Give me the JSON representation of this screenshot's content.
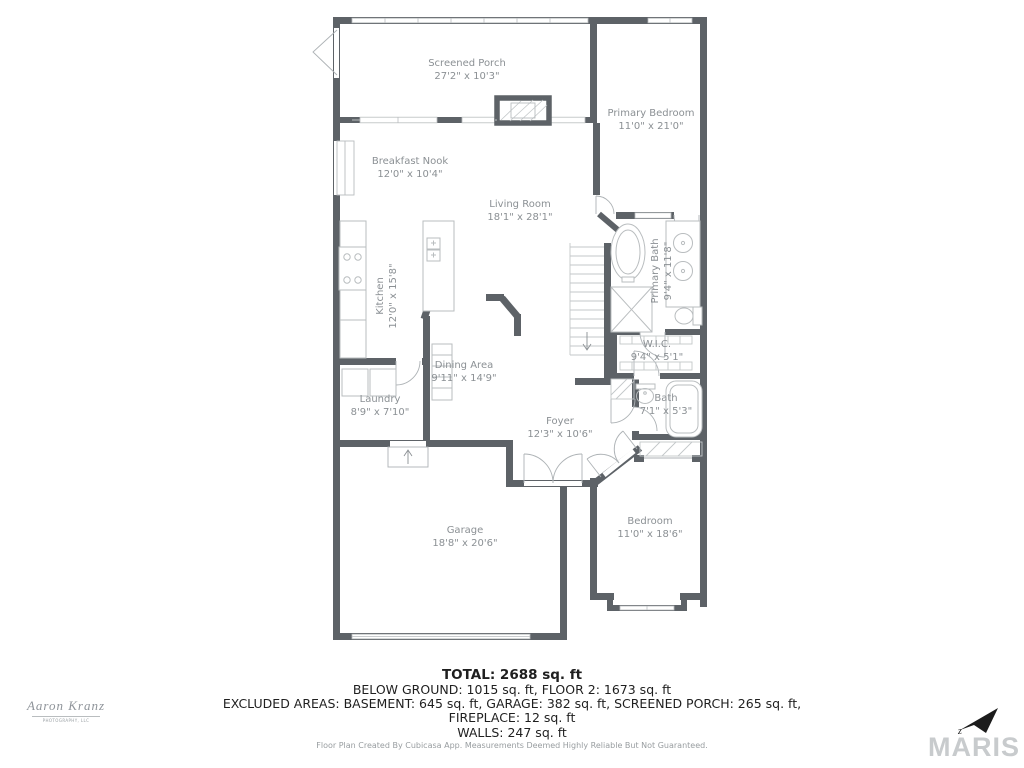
{
  "rooms": {
    "screened_porch": {
      "name": "Screened Porch",
      "dims": "27'2\" x 10'3\""
    },
    "primary_bedroom": {
      "name": "Primary Bedroom",
      "dims": "11'0\" x 21'0\""
    },
    "breakfast_nook": {
      "name": "Breakfast Nook",
      "dims": "12'0\" x 10'4\""
    },
    "living_room": {
      "name": "Living Room",
      "dims": "18'1\" x 28'1\""
    },
    "kitchen": {
      "name": "Kitchen",
      "dims": "12'0\" x 15'8\""
    },
    "primary_bath": {
      "name": "Primary Bath",
      "dims": "9'4\" x 11'8\""
    },
    "wic": {
      "name": "W.I.C.",
      "dims": "9'4\" x 5'1\""
    },
    "dining_area": {
      "name": "Dining Area",
      "dims": "9'11\" x 14'9\""
    },
    "laundry": {
      "name": "Laundry",
      "dims": "8'9\" x 7'10\""
    },
    "foyer": {
      "name": "Foyer",
      "dims": "12'3\" x 10'6\""
    },
    "bath": {
      "name": "Bath",
      "dims": "7'1\" x 5'3\""
    },
    "garage": {
      "name": "Garage",
      "dims": "18'8\" x 20'6\""
    },
    "bedroom": {
      "name": "Bedroom",
      "dims": "11'0\" x 18'6\""
    }
  },
  "summary": {
    "total": "TOTAL: 2688 sq. ft",
    "below_ground": "BELOW GROUND: 1015 sq. ft, FLOOR 2: 1673 sq. ft",
    "excluded": "EXCLUDED AREAS: BASEMENT: 645 sq. ft, GARAGE: 382 sq. ft, SCREENED PORCH: 265 sq. ft,",
    "fireplace": "FIREPLACE: 12 sq. ft",
    "walls": "WALLS: 247 sq. ft",
    "disclaimer": "Floor Plan Created By Cubicasa App. Measurements Deemed Highly Reliable But Not Guaranteed."
  },
  "branding": {
    "photographer": "Aaron Kranz",
    "photographer_sub": "PHOTOGRAPHY, LLC",
    "mls": "MARIS",
    "compass_letter": "z"
  },
  "colors": {
    "wall": "#5d6267",
    "fixture_line": "#b9bdbf",
    "room_label": "#8b9094",
    "summary_text": "#1f1f1f",
    "watermark": "#c8cbcd"
  }
}
